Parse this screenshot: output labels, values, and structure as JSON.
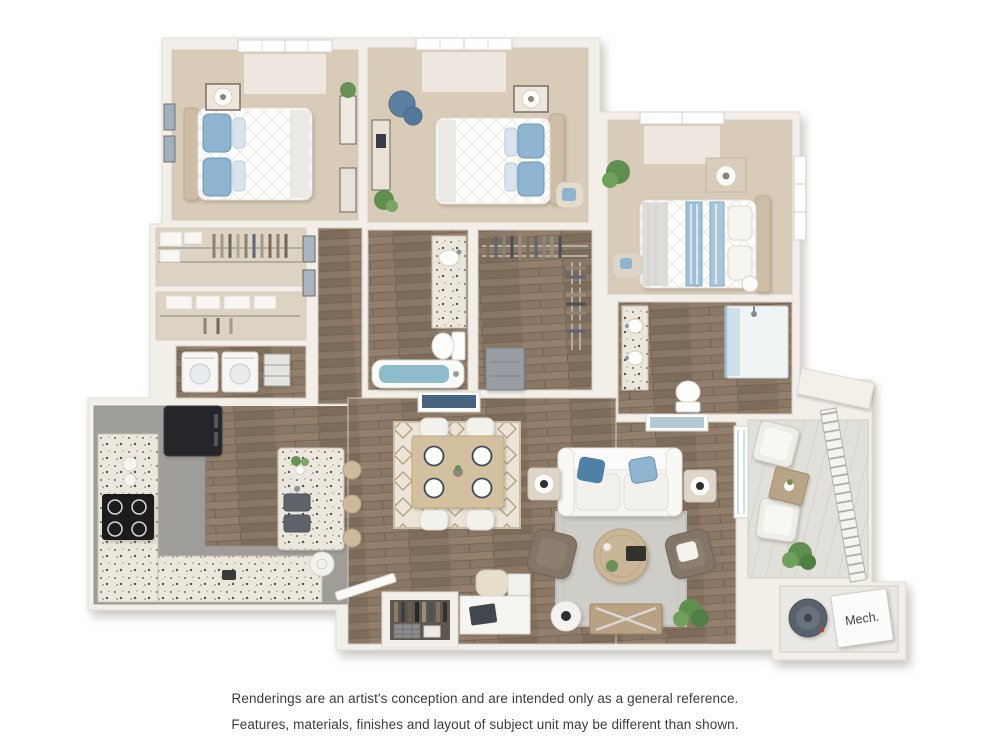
{
  "floor_plan": {
    "mech_label": "Mech.",
    "rooms": [
      "bedroom-1",
      "bedroom-2",
      "master-bedroom",
      "closet",
      "linen-closet",
      "laundry",
      "hallway",
      "bathroom",
      "walk-in-closet",
      "master-bathroom",
      "kitchen",
      "dining-area",
      "living-room",
      "entry",
      "entry-closet",
      "patio",
      "mechanical-room"
    ],
    "fixtures": [
      "bed",
      "desk",
      "blue-chair",
      "nightstand-lamps",
      "washer-dryer",
      "refrigerator",
      "cooktop",
      "kitchen-island",
      "bar-stools",
      "dining-table-4-chairs",
      "tufted-sofa",
      "armchairs",
      "coffee-table",
      "media-console",
      "work-desk",
      "bathtub",
      "shower",
      "toilet",
      "vanity",
      "water-heater",
      "patio-chairs",
      "balcony-railing"
    ],
    "palette": {
      "background": "#ffffff",
      "walls": "#f2efe9",
      "carpet": "#d8cbb8",
      "hardwood": "#8a7866",
      "kitchen_floor": "#9e9d99",
      "granite": "#ebe7dd",
      "accent_blue": "#6f9cbd",
      "tub_water": "#8fbccb",
      "upholstery_brown": "#837567",
      "plant_green": "#5f8f4f"
    }
  },
  "disclaimer": {
    "line1": "Renderings are an artist's conception and are intended only as a general reference.",
    "line2": "Features, materials, finishes and layout of subject unit may be different than shown."
  }
}
